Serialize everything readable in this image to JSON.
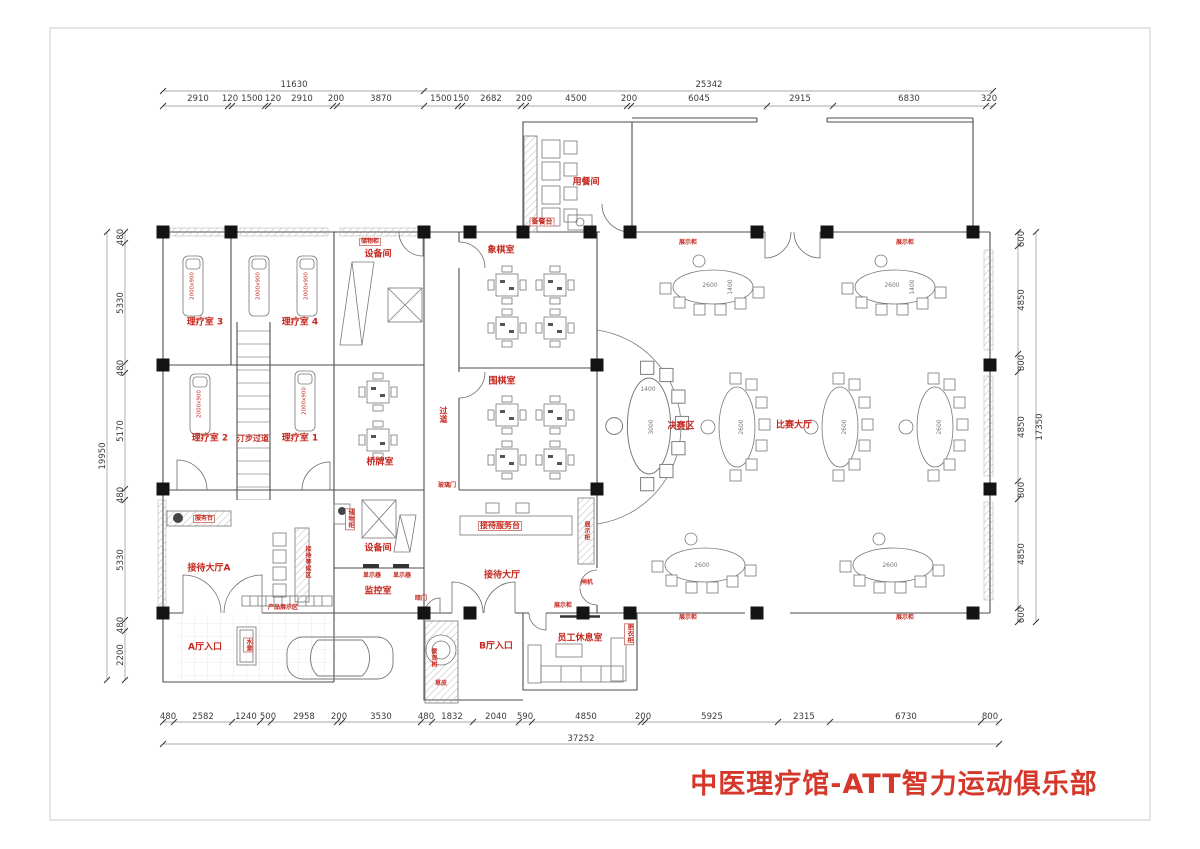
{
  "sheet": {
    "title": "中医理疗馆-ATT智力运动俱乐部",
    "title_color": "#d5372a",
    "label_color": "#c4271e"
  },
  "dims": {
    "top_overall": [
      "11630",
      "25342"
    ],
    "top": [
      "2910",
      "120",
      "1500",
      "120",
      "2910",
      "200",
      "3870",
      "1500",
      "150",
      "2682",
      "200",
      "4500",
      "200",
      "6045",
      "2915",
      "6830",
      "320"
    ],
    "left": [
      "480",
      "5330",
      "480",
      "5170",
      "480",
      "5330",
      "480",
      "2200"
    ],
    "left_overall": "19950",
    "right": [
      "600",
      "4850",
      "800",
      "4850",
      "800",
      "4850",
      "600"
    ],
    "right_overall": "17350",
    "bottom": [
      "480",
      "2582",
      "1240",
      "500",
      "2958",
      "200",
      "3530",
      "480",
      "1832",
      "2040",
      "590",
      "4850",
      "200",
      "5925",
      "2315",
      "6730",
      "800"
    ],
    "bottom_overall": "37252"
  },
  "rooms": {
    "therapy3": "理疗室 3",
    "therapy4": "理疗室 4",
    "equipment_top": "设备间",
    "chess_room": "象棋室",
    "go_room": "围棋室",
    "corridor": "过道",
    "therapy2": "理疗室 2",
    "stepping_path": "汀步过道",
    "therapy1": "理疗室 1",
    "bridge_room": "桥牌室",
    "reception_hall_a": "接待大厅A",
    "reception_hall": "接待大厅",
    "equipment_2": "设备间",
    "monitor_room": "监控室",
    "reception_desk": "接待服务台",
    "finals_area": "决赛区",
    "match_hall": "比赛大厅",
    "dining_room": "用餐间",
    "pantry_counter": "备餐台",
    "staff_lounge": "员工休息室",
    "hall_a_entrance": "A厅入口",
    "hall_b_entrance": "B厅入口"
  },
  "annotations": {
    "service_counter": "服务台",
    "waiting_area": "接待等候区",
    "product_display": "产品展示区",
    "monitor_screen": "显示器",
    "hidden_door": "暗门",
    "storage_cabinet": "储物柜",
    "water_feature": "水景",
    "glass_door": "玻璃门",
    "turnstile": "闸机",
    "display_cabinet": "展示柜",
    "locker": "更衣柜",
    "landscape_tree": "景观树",
    "grass": "草皮"
  },
  "furniture": {
    "bed_size": "2000x900",
    "table_2600": "2600",
    "table_3000": "3000",
    "table_1400": "1400"
  }
}
